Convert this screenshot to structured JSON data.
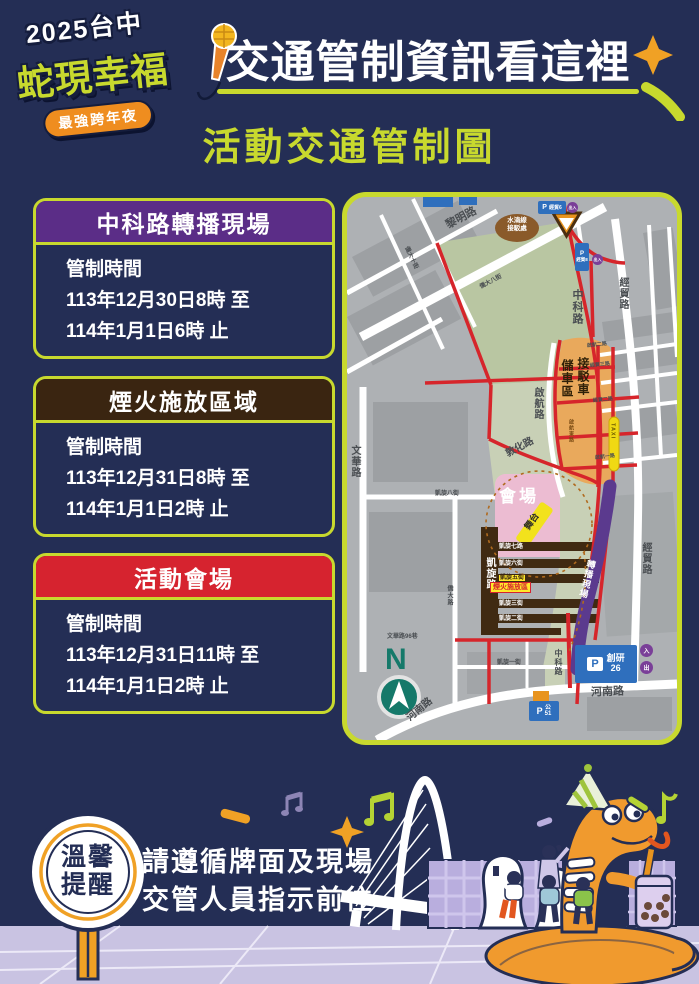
{
  "page": {
    "background": "#242e55",
    "accent": "#c8d92e"
  },
  "header": {
    "logo": {
      "line1": "2025台中",
      "line2": "蛇現幸福",
      "badge": "最強跨年夜",
      "mic_icon": "microphone",
      "badge_bg": "#ef8d1f",
      "wordmark_color": "#c8d92e"
    },
    "title": "交通管制資訊看這裡"
  },
  "section_title": "活動交通管制圖",
  "cards": [
    {
      "title": "中科路轉播現場",
      "header_color": "#5b2d87",
      "label": "管制時間",
      "time_from": "113年12月30日8時 至",
      "time_to": "114年1月1日6時 止"
    },
    {
      "title": "煙火施放區域",
      "header_color": "#3a2511",
      "label": "管制時間",
      "time_from": "113年12月31日8時 至",
      "time_to": "114年1月1日2時 止"
    },
    {
      "title": "活動會場",
      "header_color": "#d6232f",
      "label": "管制時間",
      "time_from": "113年12月31日11時 至",
      "time_to": "114年1月1日2時 止"
    }
  ],
  "map": {
    "labels": {
      "liming": "黎明路",
      "zhongke": "中科路",
      "jingmao_rd": "經貿路",
      "dunhua": "敦化路",
      "qihang_rd": "啟航路",
      "wenhua_rd": "文華路",
      "kaixuan_rd": "凱旋路",
      "henan_rd": "河南路",
      "wenhua_lane": "文華路96巷",
      "kaixuan1": "凱旋一街",
      "kaixuan2": "凱旋二街",
      "kaixuan3": "凱旋三街",
      "kaixuan5": "凱旋五街",
      "kaixuan6": "凱旋六街",
      "kaixuan7": "凱旋七路",
      "kaixuan8": "凱旋八街",
      "qiaoda_rd": "僑大路",
      "qiaoda8": "僑大八街",
      "qiaoda10": "僑大十街",
      "qihang1": "啟航一路",
      "qihang2": "啟航二路",
      "qihang_e": "啟航東路",
      "jingmao2": "經貿二路",
      "jingmao3": "經貿三路",
      "venue": "會場",
      "stage": "舞台",
      "broadcast": "轉播現場",
      "fireworks": "煙火施放區",
      "stop_l1": "水湳線",
      "stop_l2": "接駁處",
      "shuttle_l1": "接駁車",
      "shuttle_l2": "儲車區",
      "taxi": "TAXI",
      "n": "N",
      "p": "P",
      "jingmao6": "經貿6",
      "jingmao8": "經貿8",
      "chuangyan": "創研",
      "chuangyan_no": "26",
      "gong": "公",
      "gong_no": "51",
      "in": "入",
      "out": "出",
      "inout": "出入"
    },
    "legend_colors": {
      "restricted_road": "#d6252b",
      "venue_road": "#402a12",
      "shuttle_zone": "#e9a95c",
      "venue_area": "#ecbcd2",
      "broadcast_band": "#5b3a8e",
      "park": "#b9c6a2",
      "parking": "#2f6fbd"
    }
  },
  "reminder": {
    "sign_line1": "溫馨",
    "sign_line2": "提醒",
    "line1": "請遵循牌面及現場",
    "line2": "交管人員指示前往"
  }
}
